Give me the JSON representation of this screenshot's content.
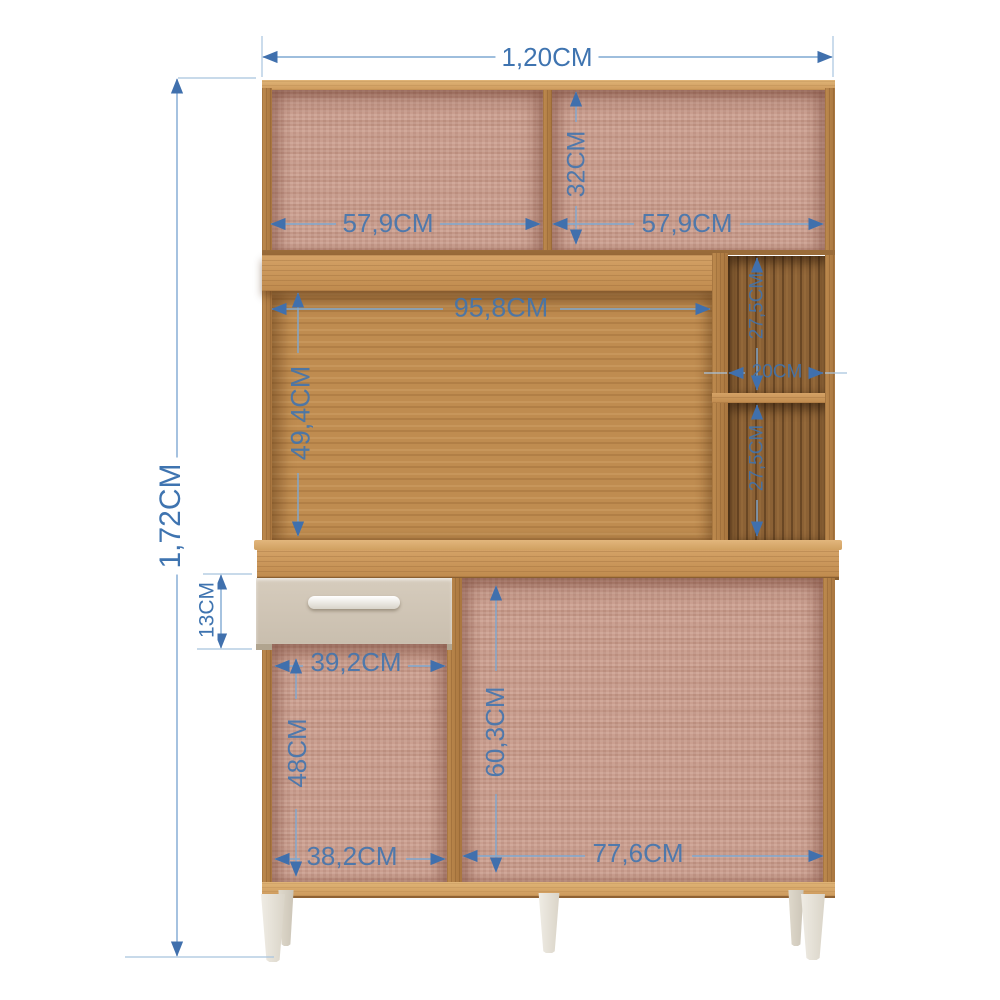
{
  "diagram": {
    "description": "kitchen cabinet dimension diagram",
    "dimensions": {
      "overall_width": "1,20CM",
      "overall_height": "1,72CM",
      "hutch_left_width": "57,9CM",
      "hutch_height": "32CM",
      "hutch_right_width": "57,9CM",
      "middle_opening_width": "95,8CM",
      "middle_opening_height": "49,4CM",
      "niche_top_height": "27,5CM",
      "niche_width": "20CM",
      "niche_bottom_height": "27,5CM",
      "drawer_height": "13CM",
      "lower_left_opening_width": "39,2CM",
      "lower_left_opening_height": "48CM",
      "lower_right_opening_height": "60,3CM",
      "bottom_left_width": "38,2CM",
      "bottom_right_width": "77,6CM"
    },
    "colors": {
      "annotation_text": "#3f74b0",
      "annotation_line": "#7fa9d2",
      "oak_frame": "#c9955a",
      "rose_backing": "#c79a8a",
      "walnut_backing": "#8b6135",
      "drawer_front": "#cfc3b3",
      "leg": "#e9e4d9",
      "background": "#ffffff"
    }
  }
}
